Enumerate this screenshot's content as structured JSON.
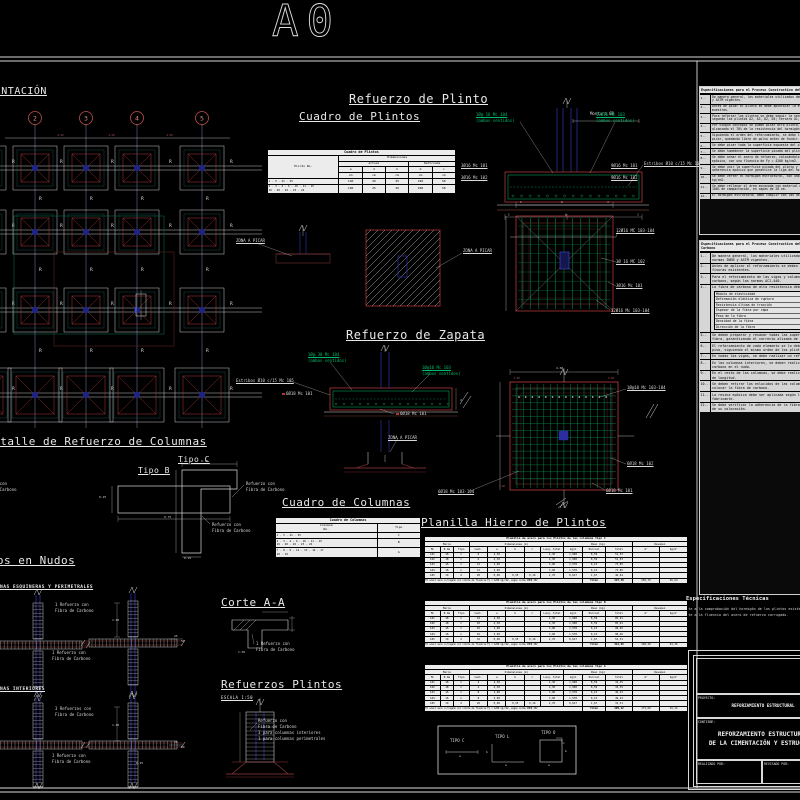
{
  "page": {
    "sheet_label": "A0"
  },
  "colors": {
    "background": "#000000",
    "line_white": "#d9d9d9",
    "cad_red": "#b03535",
    "cad_green": "#00a85c",
    "cad_blue": "#2b2f9e",
    "table_bg": "#ececec",
    "spec_bg": "#d6d6d6"
  },
  "titles": {
    "plan": "PLANTA DE CIMENTACIÓN",
    "refuerzo_plinto": "Refuerzo de Plinto",
    "cuadro_plintos": "Cuadro de Plintos",
    "refuerzo_zapata": "Refuerzo de Zapata",
    "detalle_columnas": "Detalle de Refuerzo de Columnas",
    "tipo_b": "Tipo B",
    "tipo_c": "Tipo C",
    "nudos": "Refuerzos en Nudos",
    "esquineras": "COLUMNAS ESQUINERAS Y PERIMETRALES",
    "interiores": "COLUMNAS INTERIORES",
    "cuadro_columnas": "Cuadro de Columnas",
    "planilla": "Planilla Hierro de Plintos",
    "corte": "Corte A-A",
    "refuerzos_plintos": "Refuerzos Plintos",
    "escala": "ESCALA 1:50"
  },
  "plan": {
    "bubbles": [
      "2",
      "3",
      "4",
      "5"
    ],
    "r_label": "R",
    "dim": "4.50"
  },
  "labels": {
    "montura": "Montura Ø8",
    "g1a": "1Ø@ 16 Mc 104",
    "ambos": "(ambos sentidos)",
    "g2a": "12Ø16 Mc 103",
    "estribos": "Estribos Ø10 c/15 Mc 105",
    "pl1": "3Ø16 Mc 101",
    "pl2": "3Ø16 Mc 102",
    "pr1": "9Ø16 Mc 101",
    "pr2": "9Ø16 Mc 102",
    "zona": "ZONA A PICAR",
    "d1a": "12Ø16 MC 103-104",
    "d1b": "3Ø 16 MC 102",
    "d1c": "3Ø16 Mc 101",
    "d1d": "12Ø16 Mc 103-104",
    "zg1": "1Ø@ 30 Mc 104",
    "zg2": "1Ø@10 Mc 103",
    "zb": "6Ø18 Mc 101",
    "d2a": "1Ø@10 Mc 103-104",
    "d2b": "6Ø18 Mc 102",
    "d2c": "6Ø18 Mc 101",
    "d2d": "6Ø18 Mc 103-104",
    "ref1": "Refuerzo con",
    "ref2": "Fibra de Carbono",
    "n1": "1 Refuerzo con",
    "n3": "3 Refuerzos con",
    "rp3": "3 para columnas interiores",
    "rp4": "1 para columnas perimetrales",
    "tipo_c": "TIPO C",
    "tipo_l": "TIPO L",
    "tipo_o": "TIPO O"
  },
  "dims": {
    "d075": "0.75",
    "d025": "0.25",
    "d100": "1.00",
    "d25": "25",
    "d50": "50",
    "d460": "4.60",
    "d105": "1.05",
    "d060": "0.60",
    "a": "a",
    "b": "b",
    "c": "c",
    "C": "C",
    "d": "d"
  },
  "cuadro_plintos": {
    "title": "Cuadro de Plintos",
    "col_plinto": "Plinto No.",
    "col_dim": "Dimensiones",
    "col_actual": "Actual",
    "col_ref": "Reforzada",
    "letters": [
      "a",
      "d",
      "h",
      "b",
      "c"
    ],
    "unit": "cm",
    "rows": [
      {
        "no": "1 - 5 - 21 - 25",
        "vals": [
          "140",
          "20",
          "25",
          "240",
          "50"
        ]
      },
      {
        "no": "2 - 3 - 4 - 6 - 10 - 11 - 15<br>16 - 20 - 22 - 23 - 24",
        "vals": [
          "160",
          "25",
          "20",
          "260",
          "50"
        ]
      }
    ]
  },
  "cuadro_columnas": {
    "title": "Cuadro de Columnas",
    "col1": "Columna<br>No.",
    "col2": "Tipo",
    "rows": [
      [
        "1 - 5 - 21 - 25",
        "C"
      ],
      [
        "2 - 3 - 4 - 6 - 10 - 11 - 15<br>16 - 20 - 22 - 23 - 24",
        "B"
      ],
      [
        "7 - 8 - 9 - 12 - 13 - 14 - 17<br>18 - 19",
        "A"
      ]
    ]
  },
  "planilla_headers": {
    "groups": [
      "Marca",
      "Dimensiones (m)",
      "Peso (kg)",
      "Resumen"
    ],
    "cols": [
      "Mc",
      "Ø mm",
      "Tipo",
      "Cant.",
      "a",
      "b",
      "c",
      "Long. total",
      "kg/m",
      "Parcial",
      "Total",
      "m³",
      "kg/m³"
    ],
    "total_label": "Total"
  },
  "planillas": [
    {
      "title": "Planilla de acero para los Plintos de las columnas tipo C",
      "rows": [
        [
          "101",
          "18",
          "C",
          "6",
          "4,30",
          "",
          "",
          "4,30",
          "1,998",
          "8,59",
          "51,53",
          "",
          ""
        ],
        [
          "102",
          "18",
          "C",
          "6",
          "4,30",
          "",
          "",
          "4,30",
          "1,998",
          "8,59",
          "51,53",
          "",
          ""
        ],
        [
          "103",
          "16",
          "C",
          "12",
          "3,90",
          "",
          "",
          "3,90",
          "1,578",
          "6,15",
          "73,85",
          "",
          ""
        ],
        [
          "104",
          "16",
          "C",
          "12",
          "3,90",
          "",
          "",
          "3,90",
          "1,578",
          "6,15",
          "73,85",
          "",
          ""
        ],
        [
          "105",
          "10",
          "O",
          "28",
          "0,90",
          "0,35",
          "0,10",
          "2,70",
          "0,617",
          "1,67",
          "46,64",
          "",
          ""
        ]
      ],
      "footer": {
        "note": "El acero será corrugado con límite de fluencia Fy = 4200 kg/cm2, según norma INEN 102",
        "total": "297,40",
        "res": [
          "250,76",
          "46,64"
        ]
      }
    },
    {
      "title": "Planilla de acero para los Plintos de las columnas tipo B",
      "rows": [
        [
          "101",
          "18",
          "C",
          "10",
          "4,30",
          "",
          "",
          "4,30",
          "1,998",
          "8,59",
          "85,91",
          "",
          ""
        ],
        [
          "102",
          "18",
          "C",
          "10",
          "4,30",
          "",
          "",
          "4,30",
          "1,998",
          "8,59",
          "85,91",
          "",
          ""
        ],
        [
          "103",
          "16",
          "C",
          "16",
          "3,90",
          "",
          "",
          "3,90",
          "1,578",
          "6,15",
          "98,46",
          "",
          ""
        ],
        [
          "104",
          "16",
          "C",
          "16",
          "3,90",
          "",
          "",
          "3,90",
          "1,578",
          "6,15",
          "98,46",
          "",
          ""
        ],
        [
          "105",
          "10",
          "O",
          "32",
          "0,90",
          "0,35",
          "0,10",
          "2,70",
          "0,617",
          "1,67",
          "53,31",
          "",
          ""
        ]
      ],
      "footer": {
        "note": "El acero será corrugado con límite de fluencia Fy = 4200 kg/cm2, según norma INEN 102",
        "total": "412,66",
        "res": [
          "348,20",
          "64,46"
        ]
      }
    },
    {
      "title": "Planilla de acero para los Plintos de las columnas tipo A",
      "rows": [
        [
          "101",
          "18",
          "C",
          "4",
          "4,30",
          "",
          "",
          "4,30",
          "1,998",
          "8,59",
          "34,35",
          "",
          ""
        ],
        [
          "102",
          "18",
          "C",
          "4",
          "4,30",
          "",
          "",
          "4,30",
          "1,998",
          "8,59",
          "34,35",
          "",
          ""
        ],
        [
          "103",
          "16",
          "C",
          "8",
          "3,90",
          "",
          "",
          "3,90",
          "1,578",
          "6,15",
          "49,23",
          "",
          ""
        ],
        [
          "104",
          "16",
          "C",
          "8",
          "3,90",
          "",
          "",
          "3,90",
          "1,578",
          "6,15",
          "49,23",
          "",
          ""
        ],
        [
          "105",
          "10",
          "O",
          "20",
          "0,90",
          "0,35",
          "0,10",
          "2,70",
          "0,617",
          "1,67",
          "33,31",
          "",
          ""
        ]
      ],
      "footer": {
        "note": "El acero será corrugado con límite de fluencia Fy = 4200 kg/cm2, según norma INEN 102",
        "total": "205,12",
        "res": [
          "173,00",
          "32,12"
        ]
      }
    }
  ],
  "specs1": {
    "header": "Especificaciones para el Proceso Constructivo del Reforzamiento de Plintos",
    "items": [
      {
        "n": "1.-",
        "t": "De manera general, los materiales utilizados deben cumplir con las normas INEN y ASTM vigentes."
      },
      {
        "n": "2.-",
        "t": "Antes de picar el plinto se debe apuntalar la estructura y retirar todas las muestras."
      },
      {
        "n": "3.-",
        "t": "Para reforzar los plintos se debe seguir la secuencia: primero B2, B3, C2, C3; segundo los plintos A2, A3, D2, D3; tercero A1, C1, B1, B4, D1 y D4."
      },
      {
        "n": "4.-",
        "t": "Por ningún concepto se puede picar otro plinto, sin que el anterior haya alcanzado el 70% de la resistencia del hormigón."
      },
      {
        "n": "5.-",
        "t": "Siguiendo el orden del reforzamiento, se debe limpiar muy bien la zona a picar, quedando libre de polvo antes de fundir."
      },
      {
        "n": "6.-",
        "t": "Se debe picar toda la superficie expuesta del plinto."
      },
      {
        "n": "7.-",
        "t": "Se debe humedecer la superficie picada del plinto."
      },
      {
        "n": "8.-",
        "t": "Se debe armar el acero de refuerzo, colocándolo y anclándolo con resina epóxica, con una fluencia de Fy = 4200 kg/cm2."
      },
      {
        "n": "9.-",
        "t": "Se debe unir la superficie picada del plinto y la nueva con un puente de adherencia epóxico que garantice la liga del hormigón fresco con el existente."
      },
      {
        "n": "10.-",
        "t": "Se debe verter el hormigón estructural, con una resistencia de f'c = 210 kg/cm2."
      },
      {
        "n": "11.-",
        "t": "Se debe rellenar el área excavada con material mejorado, con un porcentaje del 100% de compactación, en capas de 20 cm."
      },
      {
        "n": "12.-",
        "t": "El hormigón estructural debe cumplir con las normas del MOP-001-2002."
      }
    ]
  },
  "specs2": {
    "header": "Especificaciones para el Proceso Constructivo del Reforzamiento con Fibra de Carbono",
    "items": [
      {
        "n": "1.-",
        "t": "De manera general, los materiales utilizados deben cumplir con las normas INEN y ASTM vigentes."
      },
      {
        "n": "2.-",
        "t": "Antes de aplicar el reforzamiento se deben picar y resanar todas las fisuras existentes."
      },
      {
        "n": "3.-",
        "t": "Para el reforzamiento de las vigas y columnas, se aplicará fibra de carbono, según las normas ACI-440."
      },
      {
        "n": "4.-",
        "t": "La fibra de carbono de alta resistencia debe cumplir:",
        "props": [
          [
            "Módulo de elasticidad",
            "≥ 227.000 MPa"
          ],
          [
            "Deformación elástica de ruptura",
            "≥ 1.80 %"
          ],
          [
            "Resistencia última de tracción",
            "≥ 2.750 MPa"
          ],
          [
            "Espesor de la fibra por capa",
            "≥ 0.168 mm"
          ],
          [
            "Peso de la fibra",
            "≥ 300 g/m²"
          ],
          [
            "Densidad de la fibra",
            "≥ 1.8 g/cm³"
          ],
          [
            "Dirección de la fibra",
            "Unidireccional"
          ]
        ]
      },
      {
        "n": "5.-",
        "t": "Se deben preparar y resanar todas las superficies donde se colocará la fibra, garantizando el correcto alisado de las mismas."
      },
      {
        "n": "6.-",
        "t": "El reforzamiento de cada elemento se lo debe realizar a nivel de cada piso, siguiendo el mismo orden de los plintos."
      },
      {
        "n": "7.-",
        "t": "En todas las vigas, se debe realizar un reforzamiento en el nudo."
      },
      {
        "n": "8.-",
        "t": "En las columnas interiores, se deben realizar 3 refuerzos con fibra de carbono en el nudo."
      },
      {
        "n": "9.-",
        "t": "En el resto de las columnas, se debe realizar un reforzamiento de 1.00 m de longitud."
      },
      {
        "n": "10.-",
        "t": "Se deben retirar los enlucidos de las columnas y vigas donde se debe colocar la fibra de carbono."
      },
      {
        "n": "11.-",
        "t": "La resina epóxica debe ser aplicada según las especificaciones del fabricante."
      },
      {
        "n": "12.-",
        "t": "Se debe verificar la adherencia de la fibra de carbono luego de 7 días de su colocación."
      }
    ]
  },
  "tech": {
    "title": "Especificaciones Técnicas",
    "line1": "Referente a la comprobación del hormigón de los plintos existentes.",
    "line2": "Referente a la fluencia del acero de refuerzo corrugado."
  },
  "titleblock": {
    "proyecto_label": "PROYECTO:",
    "proyecto": "REFORZAMIENTO ESTRUCTURAL",
    "contiene_label": "CONTIENE:",
    "contiene_l1": "REFORZAMIENTO ESTRUCTURAL",
    "contiene_l2": "DE LA CIMENTACIÓN Y ESTRUCTURA",
    "realizado_label": "REALIZADO POR:",
    "revisado_label": "REVISADO POR:"
  }
}
